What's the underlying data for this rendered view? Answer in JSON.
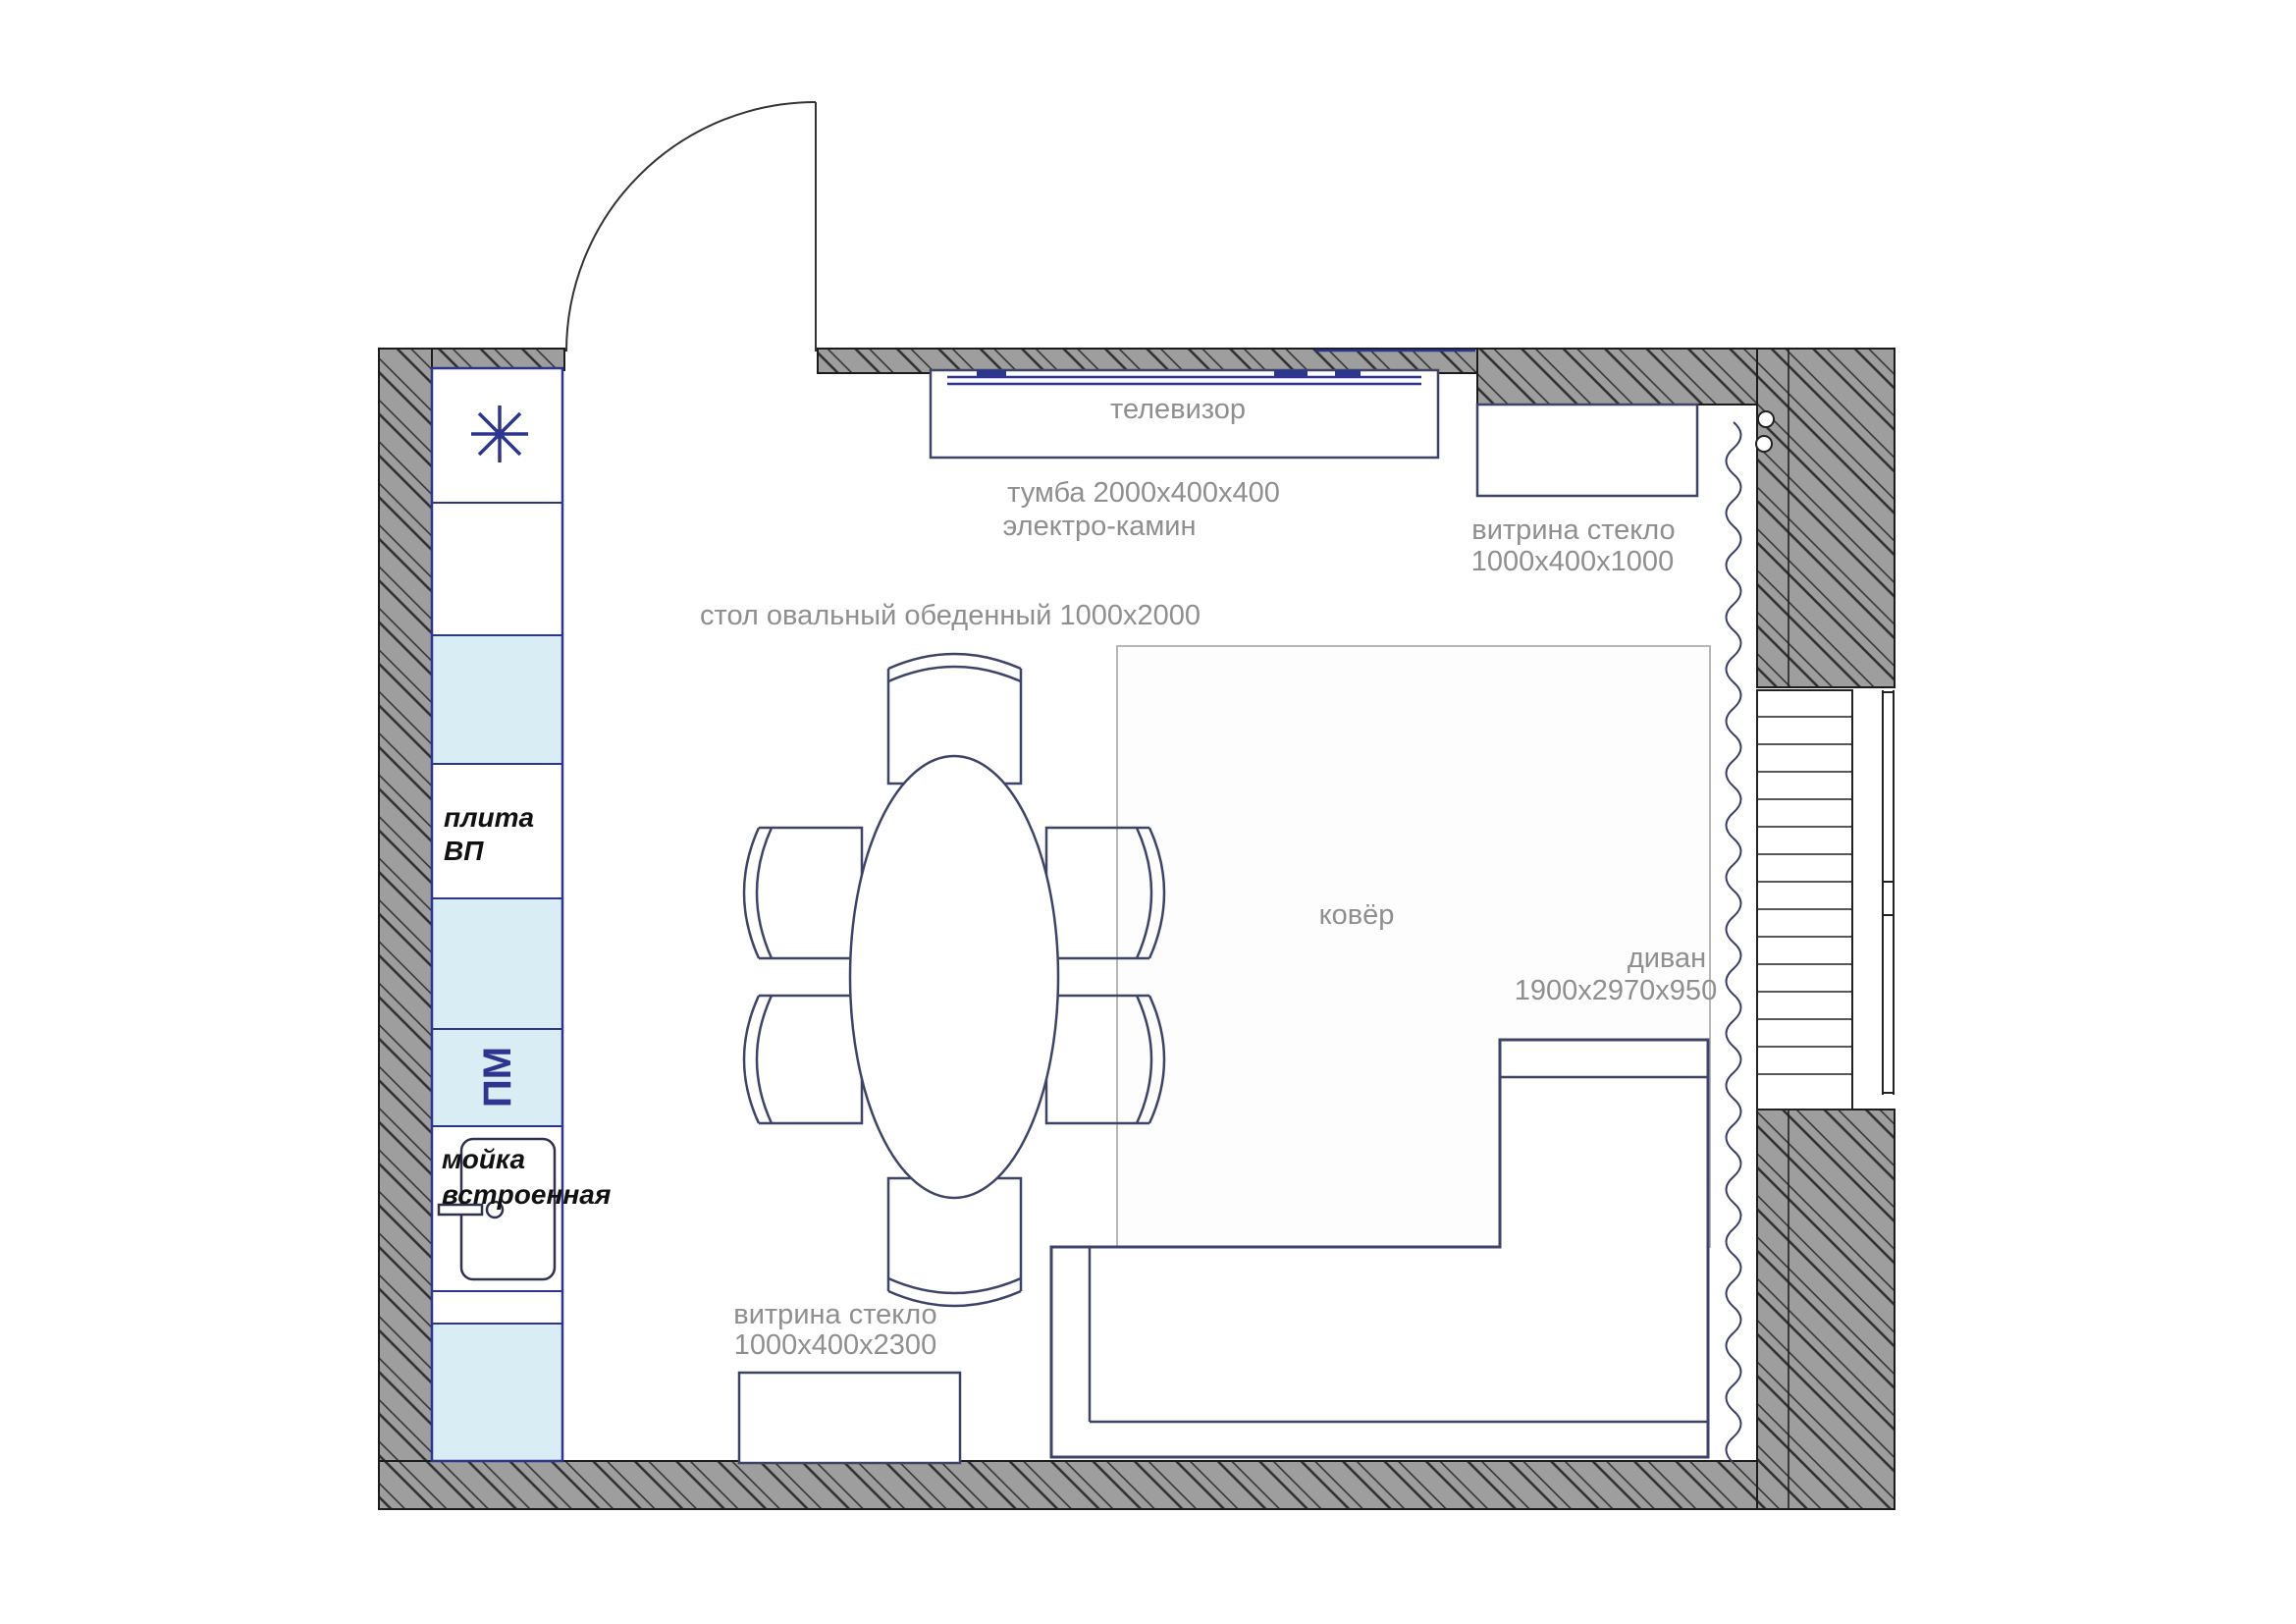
{
  "labels": {
    "tv": "телевизор",
    "tv_stand_dim": "тумба 2000х400х400",
    "fireplace": "электро-камин",
    "vitrine_top_name": "витрина стекло",
    "vitrine_top_dim": "1000х400х1000",
    "dining_table": "стол овальный обеденный 1000х2000",
    "carpet": "ковёр",
    "sofa_name": "диван",
    "sofa_dim": "1900х2970х950",
    "vitrine_bottom_name": "витрина стекло",
    "vitrine_bottom_dim": "1000х400х2300",
    "stove_line1": "плита",
    "stove_line2": "ВП",
    "dishwasher": "ПМ",
    "sink_line1": "мойка",
    "sink_line2": "встроенная"
  },
  "colors": {
    "wallGray": "#9e9e9e",
    "navy": "#2c3590",
    "furn": "#3d4468",
    "lightBlue": "#d9edf5",
    "labelGray": "#8f8f8f",
    "carpetEdge": "#b8b8b8",
    "paper": "#ffffff"
  }
}
